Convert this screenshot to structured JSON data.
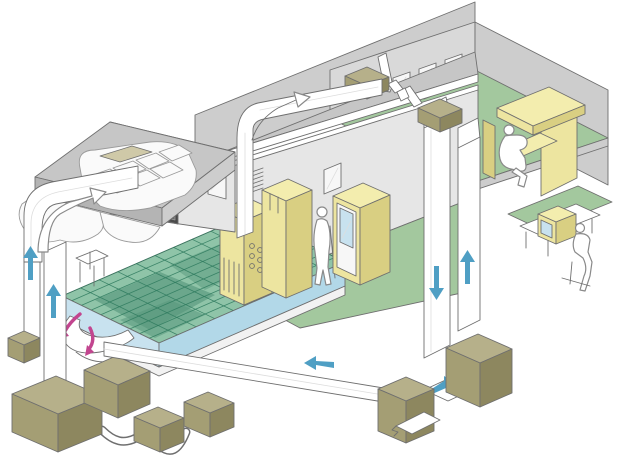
{
  "figure": {
    "type": "isometric-technical-illustration",
    "subject": "building-air-conditioning-and-raised-floor-airflow-cutaway",
    "width_px": 640,
    "height_px": 467
  },
  "colors": {
    "white": "#ffffff",
    "outline": "#6f6f6f",
    "person_line": "#8a8a8a",
    "roof_top": "#c6c6c6",
    "roof_side": "#b4b4b4",
    "wall_mid": "#cdcdcd",
    "wall_light": "#e6e6e6",
    "wall_back": "#d9d9d9",
    "floor_green": "#a3c89e",
    "grid_base": "#8fc4a8",
    "grid_line": "#2e7a5e",
    "grid_tint": "#58987c",
    "fascia_light": "#c8e2ef",
    "fascia_mid": "#b2d8e8",
    "platform_base": "#f2f2f2",
    "yellow_top": "#f3edae",
    "yellow_front": "#ede5a0",
    "yellow_side": "#d9cf82",
    "khaki_top": "#b6b08a",
    "khaki_front": "#a49e74",
    "khaki_side": "#8d875f",
    "duct_fill": "#ffffff",
    "duct_line": "#dddddd",
    "window_fill": "#f7f7f7",
    "tile_fill": "#fafafa",
    "tile_line": "#9a9a9a",
    "beige": "#cfc9a8",
    "dark_box": "#4a4a4a",
    "dark_box_inner": "#6a6a6a",
    "arrow_blue": "#4f9fc4",
    "arrow_pink": "#c2458f"
  },
  "rooms": [
    {
      "id": "machine-room",
      "label": "raised-floor machine room"
    },
    {
      "id": "equipment-corridor",
      "label": "corridor with control cabinets"
    },
    {
      "id": "office",
      "label": "upper office with desks"
    },
    {
      "id": "plant",
      "label": "outdoor plant equipment"
    },
    {
      "id": "outdoor-workstation",
      "label": "operator desk with monitor"
    }
  ],
  "airflow_arrows": {
    "blue": [
      {
        "id": "supply-riser-left-rear",
        "direction": "up"
      },
      {
        "id": "supply-riser-left-front",
        "direction": "up"
      },
      {
        "id": "supply-drop-right",
        "direction": "down"
      },
      {
        "id": "return-riser-right",
        "direction": "up"
      },
      {
        "id": "return-main-duct",
        "direction": "left"
      },
      {
        "id": "ahu-crossover-duct",
        "direction": "right"
      }
    ],
    "pink": [
      {
        "id": "underfloor-plenum-flow-1",
        "direction": "curved-down-left"
      },
      {
        "id": "underfloor-plenum-flow-2",
        "direction": "curved-down"
      }
    ],
    "white_outline": [
      {
        "id": "duct-bend-flow-left",
        "direction": "up-right"
      },
      {
        "id": "room-inlet-flow",
        "direction": "up-right"
      }
    ]
  },
  "equipment": [
    {
      "id": "ceiling-fan-coil-1"
    },
    {
      "id": "ceiling-fan-coil-2"
    },
    {
      "id": "plant-box-small-left"
    },
    {
      "id": "plant-box-large"
    },
    {
      "id": "plant-box-mid"
    },
    {
      "id": "plant-box-r1"
    },
    {
      "id": "plant-box-r2"
    },
    {
      "id": "ahu-bottom-right"
    },
    {
      "id": "ahu-bottom-left"
    },
    {
      "id": "control-cabinet"
    },
    {
      "id": "tall-cabinet"
    },
    {
      "id": "glass-door-cabinet"
    },
    {
      "id": "wall-control-panel"
    },
    {
      "id": "underfloor-fan-scoop"
    },
    {
      "id": "floor-stand-table"
    },
    {
      "id": "desk-monitor"
    }
  ],
  "people": [
    {
      "id": "person-office",
      "pose": "sitting-reading"
    },
    {
      "id": "person-corridor",
      "pose": "standing"
    },
    {
      "id": "person-outdoor-desk",
      "pose": "sitting-at-computer"
    }
  ]
}
